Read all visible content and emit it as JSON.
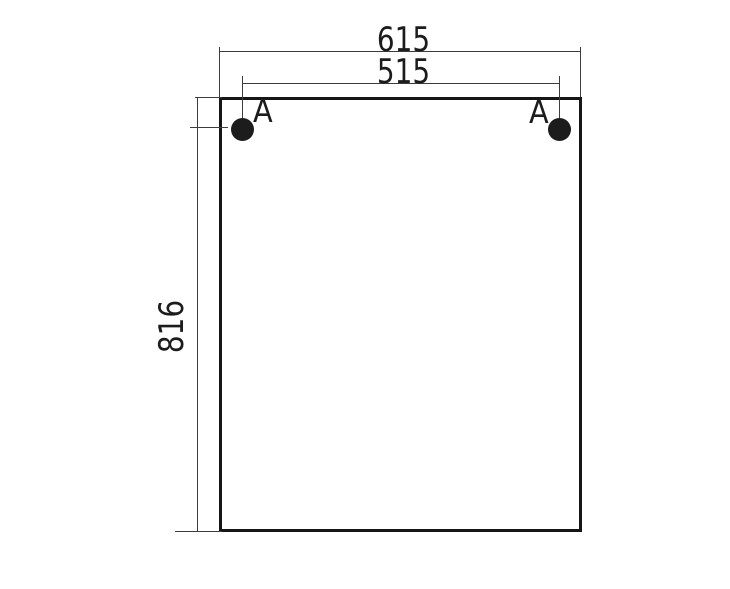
{
  "drawing": {
    "type": "technical-dimension-drawing",
    "subject": "rectangular panel front view with two mounting holes",
    "dimensions": {
      "overall_width": "615",
      "hole_spacing_width": "515",
      "overall_height": "816"
    },
    "labels": {
      "hole_left": "A",
      "hole_right": "A"
    },
    "colors": {
      "background": "#ffffff",
      "outline": "#161616",
      "dimension_lines": "#3d3d3d",
      "text": "#1c1c1c",
      "hole_fill": "#1c1c1c"
    }
  }
}
